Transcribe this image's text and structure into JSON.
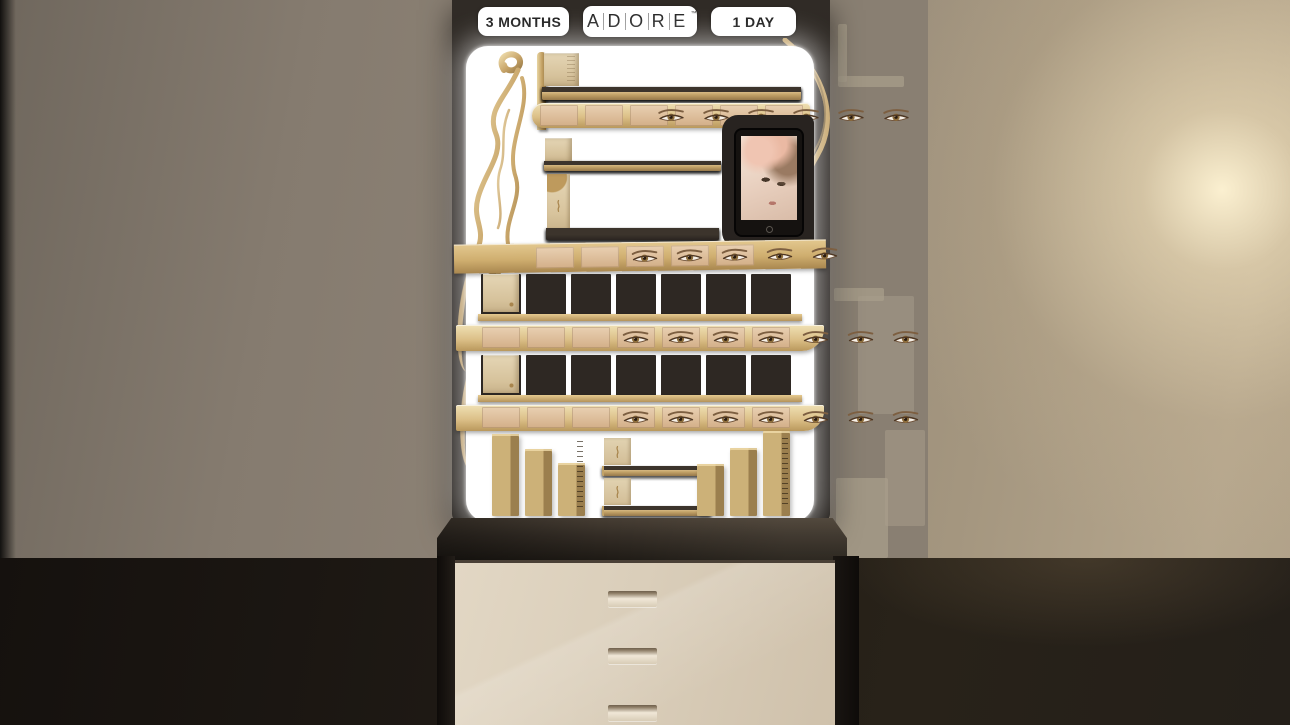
{
  "header": {
    "left_pill": "3 MONTHS",
    "right_pill": "1 DAY",
    "logo": {
      "letters": [
        "A",
        "D",
        "O",
        "R",
        "E"
      ],
      "trademark": "™"
    }
  },
  "display": {
    "row1": {
      "count": 6
    },
    "eyes_strip1": {
      "count": 6
    },
    "row2_small": {
      "count": 5
    },
    "row2_tall": {
      "count": 5
    },
    "eyes_strip2": {
      "count": 5
    },
    "row3": {
      "count": 7
    },
    "eyes_strip3": {
      "count": 7
    },
    "row4": {
      "count": 7
    },
    "eyes_strip4": {
      "count": 7
    },
    "bottom": {
      "left_towers": 3,
      "cubes_top": 3,
      "cubes_bottom": 3,
      "right_towers": 3
    }
  },
  "cabinet": {
    "drawer_count": 3
  },
  "colors": {
    "gold": "#c9a66a",
    "frame_dark": "#2a2521",
    "panel_white": "#ffffff",
    "cabinet_beige": "#d8ccb8",
    "wall_left": "#8b8175",
    "wall_right": "#b3a48e",
    "floor_dark": "#221d18",
    "glow_warm": "#f7e9c6",
    "pill_background": "#ffffff",
    "pill_text": "#1b1b1b"
  }
}
